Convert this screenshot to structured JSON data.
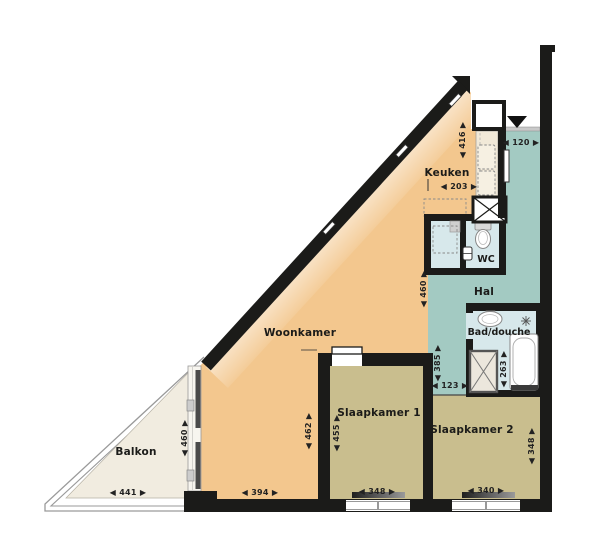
{
  "plan": {
    "type": "apartment-floor-plan",
    "rooms": {
      "woonkamer": {
        "label": "Woonkamer"
      },
      "keuken": {
        "label": "Keuken"
      },
      "hal": {
        "label": "Hal"
      },
      "wc": {
        "label": "WC"
      },
      "bad_douche": {
        "label": "Bad/douche"
      },
      "slaapkamer1": {
        "label": "Slaapkamer 1"
      },
      "slaapkamer2": {
        "label": "Slaapkamer 2"
      },
      "balkon": {
        "label": "Balkon"
      }
    },
    "dimensions": {
      "keuken_depth": "◀ 416 ▶",
      "entree_width": "◀ 120 ▶",
      "keuken_width": "◀ 203 ▶",
      "hal_depth": "◀ 460 ▶",
      "hal_lower_depth": "◀ 385 ▶",
      "hal_passage_width": "◀ 123 ▶",
      "bad_depth": "◀ 263 ▶",
      "woonkamer_depth": "◀ 462 ▶",
      "slaapkamer1_depth": "◀ 455 ▶",
      "woonkamer_width": "◀ 394 ▶",
      "slaapkamer1_width": "◀ 348 ▶",
      "slaapkamer2_width": "◀ 340 ▶",
      "slaapkamer2_depth": "◀ 348 ▶",
      "balkon_width": "◀ 441 ▶",
      "balkon_depth": "◀ 460 ▶"
    },
    "colors": {
      "wall": "#1b1b19",
      "living": "#f3c78e",
      "bedroom": "#c9be8e",
      "hall": "#a3cac2",
      "bath": "#d7e8eb",
      "balcony": "#f1ece0",
      "counter": "#f1e9d8",
      "frame_gray": "#999999"
    }
  }
}
